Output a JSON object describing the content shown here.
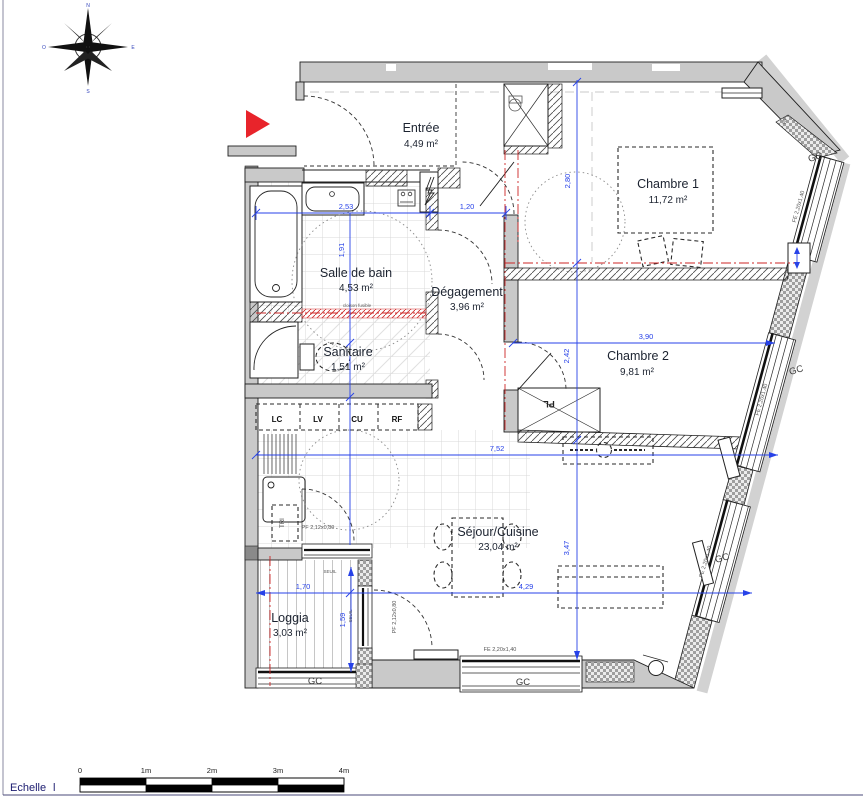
{
  "compass": {
    "north": "N",
    "south": "S",
    "east": "E",
    "west": "O"
  },
  "rooms": {
    "entree": {
      "name": "Entrée",
      "area": "4,49 m²"
    },
    "chambre1": {
      "name": "Chambre 1",
      "area": "11,72 m²"
    },
    "salle_de_bain": {
      "name": "Salle de bain",
      "area": "4,53 m²"
    },
    "degagement": {
      "name": "Dégagement",
      "area": "3,96 m²"
    },
    "sanitaire": {
      "name": "Sanitaire",
      "area": "1,51 m²"
    },
    "chambre2": {
      "name": "Chambre 2",
      "area": "9,81 m²"
    },
    "sejour_cuisine": {
      "name": "Séjour/Cuisine",
      "area": "23,04 m²"
    },
    "loggia": {
      "name": "Loggia",
      "area": "3,03 m²"
    }
  },
  "dimensions": {
    "d_253": "2,53",
    "d_120": "1,20",
    "d_191": "1,91",
    "d_280": "2,80",
    "d_242": "2,42",
    "d_390": "3,90",
    "d_752": "7,52",
    "d_347": "3,47",
    "d_429": "4,29",
    "d_170": "1,70",
    "d_159": "1,59"
  },
  "kitchen": {
    "units": [
      "LC",
      "LV",
      "CU",
      "RF"
    ],
    "tri_label": "TRI"
  },
  "annotations": {
    "gc": "GC",
    "fe_window": "FE 2,20x1,40",
    "pf_kitchen": "PF 2,12x0,80",
    "pf_sejour": "PF 2,12x0,80",
    "seuil": "SEUIL",
    "vr": "VR",
    "placard": "PL",
    "cloison_fusible": "cloison fusible"
  },
  "scale_bar": {
    "label": "Echelle",
    "marker": "l",
    "ticks": [
      "0",
      "1m",
      "2m",
      "3m",
      "4m"
    ]
  },
  "colors": {
    "entrance_arrow": "#e8242b",
    "dimension_blue": "#2742e8",
    "axis_red": "#cc2626"
  }
}
